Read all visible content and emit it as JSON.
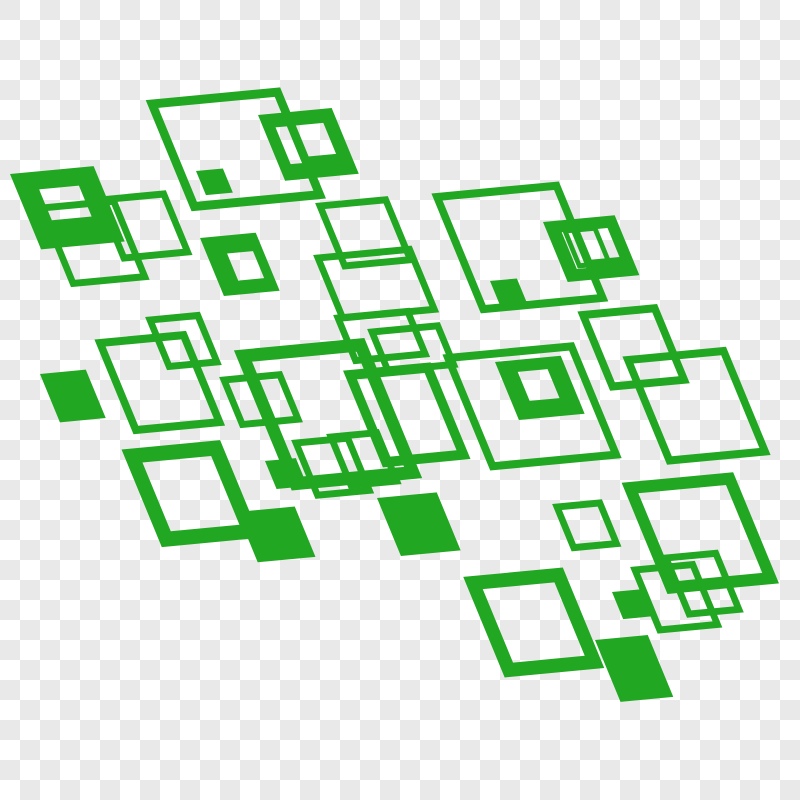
{
  "canvas": {
    "width": 800,
    "height": 800
  },
  "background": {
    "style": "transparency-checkerboard",
    "cell_size": 20,
    "color_light": "#ffffff",
    "color_gray": "#e9e9e9"
  },
  "graphic": {
    "description": "abstract-green-squares-pattern",
    "color": "#22a722",
    "skew_transform": {
      "a": 0.9956,
      "b": -0.0941,
      "c": 0.3985,
      "d": 0.9668
    },
    "squares": [
      {
        "id": "top-left-big-outline",
        "x": 152,
        "y": 104,
        "w": 126,
        "h": 106,
        "style": "outline",
        "stroke": 9
      },
      {
        "id": "top-left-small-filled",
        "x": 196,
        "y": 171,
        "w": 27,
        "h": 25,
        "style": "filled"
      },
      {
        "id": "top-ring-with-slot",
        "x": 258,
        "y": 115,
        "w": 74,
        "h": 68,
        "style": "ring",
        "holes": [
          [
            32,
            14,
            28,
            32
          ],
          [
            12,
            14,
            14,
            38
          ]
        ]
      },
      {
        "id": "top-mid-outline",
        "x": 320,
        "y": 206,
        "w": 66,
        "h": 62,
        "style": "outline",
        "stroke": 7
      },
      {
        "id": "top-right-big-outline",
        "x": 437,
        "y": 197,
        "w": 120,
        "h": 116,
        "style": "outline",
        "stroke": 8
      },
      {
        "id": "top-right-small-filled",
        "x": 490,
        "y": 281,
        "w": 27,
        "h": 26,
        "style": "filled"
      },
      {
        "id": "top-right-ring-with-slot",
        "x": 543,
        "y": 222,
        "w": 72,
        "h": 62,
        "style": "ring",
        "holes": [
          [
            32,
            12,
            28,
            30
          ],
          [
            14,
            12,
            13,
            38
          ]
        ]
      },
      {
        "id": "top-right-ring-window",
        "x": 565,
        "y": 231,
        "w": 30,
        "h": 36,
        "style": "outline",
        "stroke": 5
      },
      {
        "id": "left-ring",
        "x": 10,
        "y": 174,
        "w": 84,
        "h": 78,
        "style": "ring",
        "holes": [
          [
            22,
            18,
            40,
            32
          ]
        ]
      },
      {
        "id": "left-outline-a",
        "x": 42,
        "y": 208,
        "w": 72,
        "h": 78,
        "style": "outline",
        "stroke": 7
      },
      {
        "id": "left-outline-b",
        "x": 100,
        "y": 200,
        "w": 64,
        "h": 60,
        "style": "outline",
        "stroke": 7
      },
      {
        "id": "left-small-ring",
        "x": 200,
        "y": 238,
        "w": 56,
        "h": 60,
        "style": "ring",
        "holes": [
          [
            20,
            18,
            26,
            28
          ]
        ]
      },
      {
        "id": "mid-left-outline",
        "x": 100,
        "y": 343,
        "w": 84,
        "h": 90,
        "style": "outline",
        "stroke": 8
      },
      {
        "id": "mid-left-filled",
        "x": 40,
        "y": 374,
        "w": 46,
        "h": 50,
        "style": "filled"
      },
      {
        "id": "mid-small-outline-a",
        "x": 150,
        "y": 320,
        "w": 48,
        "h": 48,
        "style": "outline",
        "stroke": 7
      },
      {
        "id": "mid-small-outline-b",
        "x": 224,
        "y": 380,
        "w": 56,
        "h": 46,
        "style": "outline",
        "stroke": 7
      },
      {
        "id": "center-band-outline",
        "x": 318,
        "y": 258,
        "w": 92,
        "h": 62,
        "style": "outline",
        "stroke": 7
      },
      {
        "id": "center-thin-rect-a",
        "x": 338,
        "y": 318,
        "w": 70,
        "h": 44,
        "style": "outline",
        "stroke": 7
      },
      {
        "id": "center-thin-rect-b",
        "x": 372,
        "y": 332,
        "w": 66,
        "h": 40,
        "style": "outline",
        "stroke": 7
      },
      {
        "id": "center-thick-outline",
        "x": 243,
        "y": 356,
        "w": 118,
        "h": 132,
        "style": "outline",
        "stroke": 13
      },
      {
        "id": "center-medium-outline",
        "x": 350,
        "y": 375,
        "w": 78,
        "h": 90,
        "style": "outline",
        "stroke": 10
      },
      {
        "id": "center-right-big-outline",
        "x": 448,
        "y": 358,
        "w": 124,
        "h": 112,
        "style": "outline",
        "stroke": 8
      },
      {
        "id": "center-right-ring",
        "x": 495,
        "y": 362,
        "w": 66,
        "h": 60,
        "style": "ring",
        "holes": [
          [
            18,
            12,
            30,
            30
          ]
        ]
      },
      {
        "id": "right-outline-small",
        "x": 583,
        "y": 315,
        "w": 72,
        "h": 74,
        "style": "outline",
        "stroke": 8
      },
      {
        "id": "right-outline-big",
        "x": 628,
        "y": 360,
        "w": 96,
        "h": 104,
        "style": "outline",
        "stroke": 8
      },
      {
        "id": "lower-left-thick-outline",
        "x": 132,
        "y": 456,
        "w": 84,
        "h": 86,
        "style": "outline",
        "stroke": 15
      },
      {
        "id": "lower-left-filled",
        "x": 237,
        "y": 512,
        "w": 58,
        "h": 52,
        "style": "filled"
      },
      {
        "id": "lower-left-small-filled",
        "x": 265,
        "y": 461,
        "w": 31,
        "h": 29,
        "style": "filled"
      },
      {
        "id": "lower-mid-outline-a",
        "x": 296,
        "y": 443,
        "w": 52,
        "h": 54,
        "style": "outline",
        "stroke": 7
      },
      {
        "id": "lower-mid-outline-b",
        "x": 331,
        "y": 437,
        "w": 46,
        "h": 50,
        "style": "outline",
        "stroke": 7
      },
      {
        "id": "lower-center-filled",
        "x": 377,
        "y": 498,
        "w": 60,
        "h": 60,
        "style": "filled"
      },
      {
        "id": "lower-right-small-outline",
        "x": 557,
        "y": 507,
        "w": 43,
        "h": 42,
        "style": "outline",
        "stroke": 7
      },
      {
        "id": "bottom-right-big-outline",
        "x": 630,
        "y": 488,
        "w": 100,
        "h": 103,
        "style": "outline",
        "stroke": 12
      },
      {
        "id": "bottom-thick-outline",
        "x": 473,
        "y": 583,
        "w": 86,
        "h": 90,
        "style": "outline",
        "stroke": 14
      },
      {
        "id": "bottom-tall-outline-a",
        "x": 635,
        "y": 570,
        "w": 58,
        "h": 62,
        "style": "outline",
        "stroke": 7
      },
      {
        "id": "bottom-tall-outline-b",
        "x": 666,
        "y": 558,
        "w": 50,
        "h": 58,
        "style": "outline",
        "stroke": 7
      },
      {
        "id": "bottom-filled",
        "x": 595,
        "y": 640,
        "w": 53,
        "h": 64,
        "style": "filled"
      },
      {
        "id": "bottom-small-filled",
        "x": 612,
        "y": 592,
        "w": 28,
        "h": 28,
        "style": "filled"
      }
    ]
  }
}
